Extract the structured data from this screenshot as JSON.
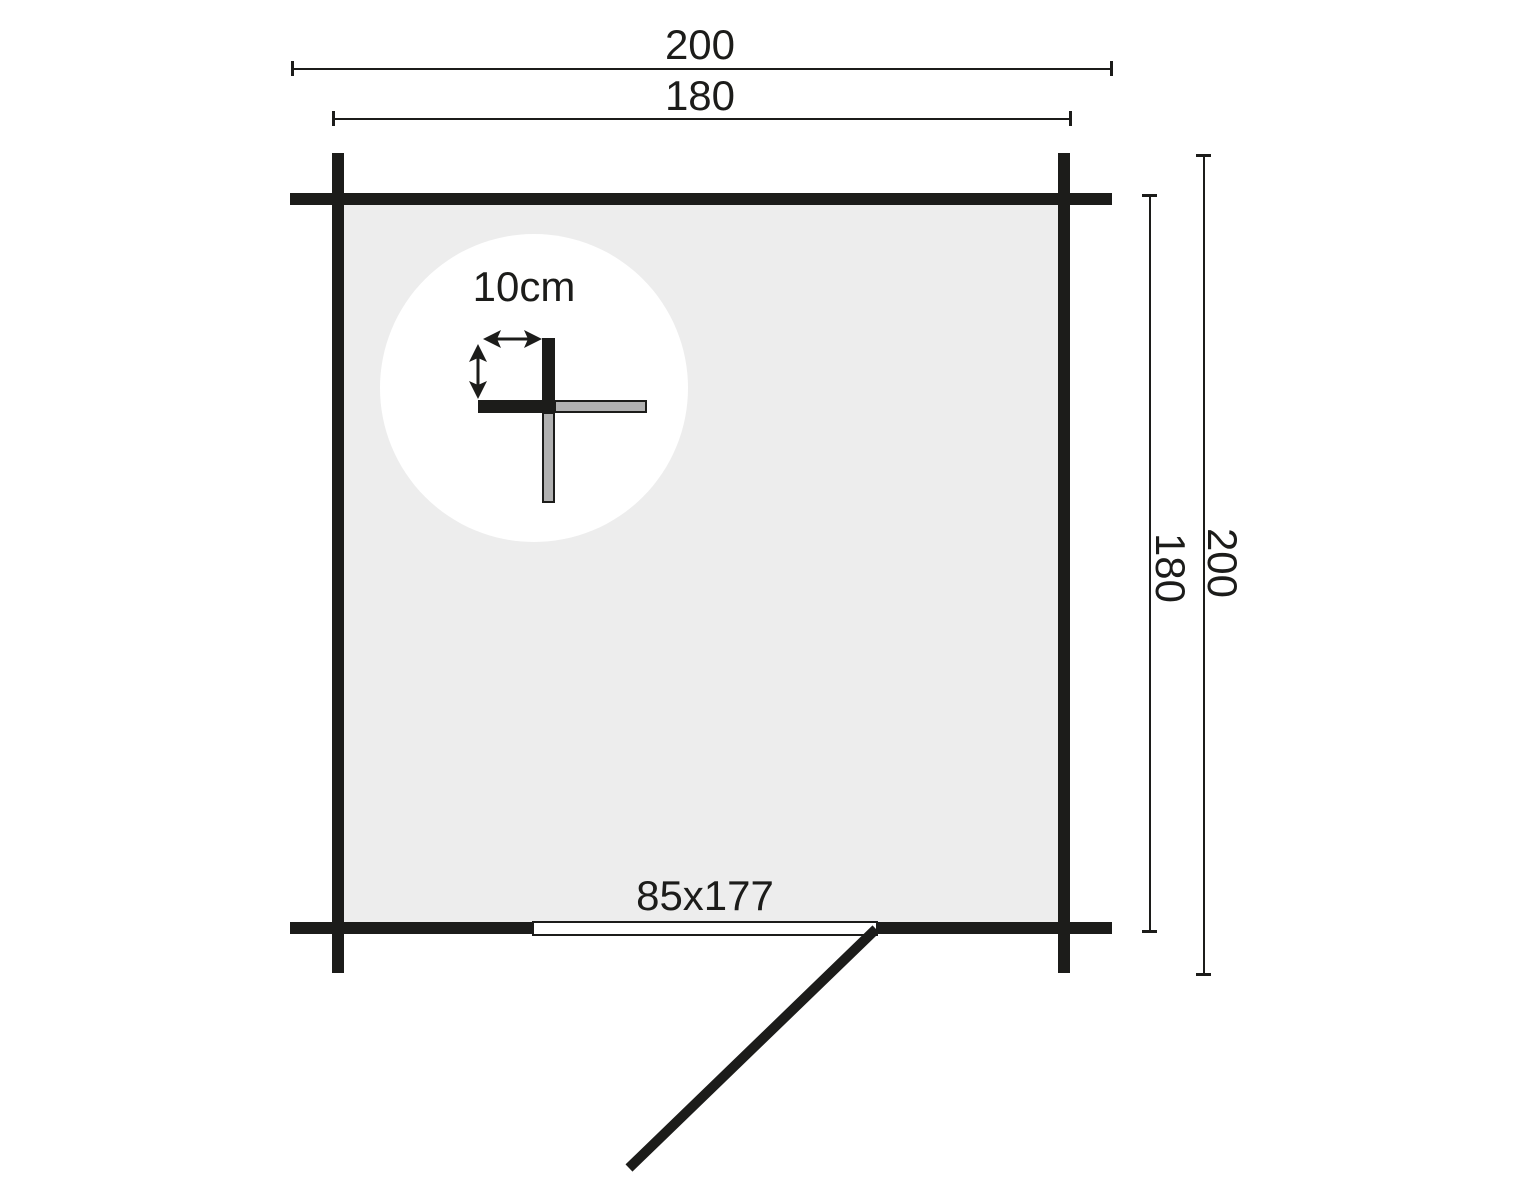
{
  "plan": {
    "dim_top_outer": "200",
    "dim_top_inner": "180",
    "dim_right_inner": "180",
    "dim_right_outer": "200",
    "door_label": "85x177",
    "detail_label": "10cm"
  },
  "colors": {
    "ink": "#1c1c1a",
    "floor_fill": "#ededed",
    "log_end_fill": "#b1b1b1",
    "background": "#ffffff"
  },
  "icons": {
    "detail_width_arrow": "double-arrow-horizontal-icon",
    "detail_height_arrow": "double-arrow-vertical-icon"
  }
}
